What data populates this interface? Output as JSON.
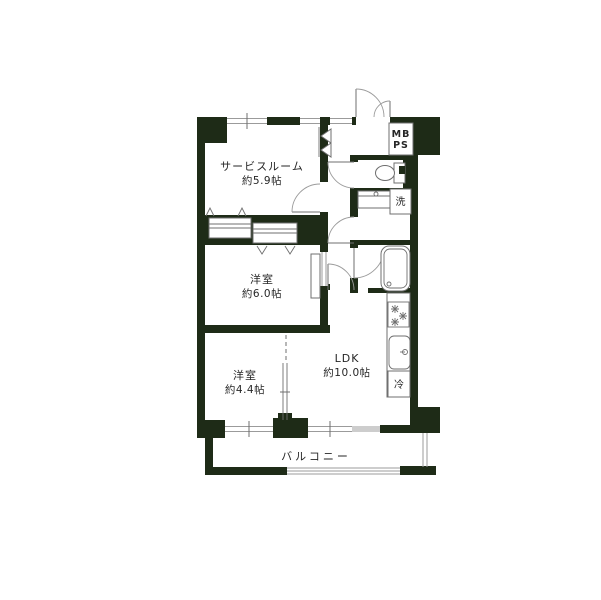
{
  "colors": {
    "wall": "#1e2b17",
    "line": "#9b9b9b",
    "fixture": "#6f6f6f",
    "text": "#262626",
    "bg": "#ffffff"
  },
  "rooms": {
    "service_room": {
      "name": "サービスルーム",
      "size": "約5.9帖"
    },
    "western_room_6": {
      "name": "洋室",
      "size": "約6.0帖"
    },
    "western_room_4_4": {
      "name": "洋室",
      "size": "約4.4帖"
    },
    "ldk": {
      "name": "LDK",
      "size": "約10.0帖"
    },
    "balcony": {
      "name": "バルコニー"
    }
  },
  "fixtures": {
    "meter_box": "MB",
    "pipe_space": "PS",
    "washing_machine": "洗",
    "refrigerator": "冷"
  }
}
